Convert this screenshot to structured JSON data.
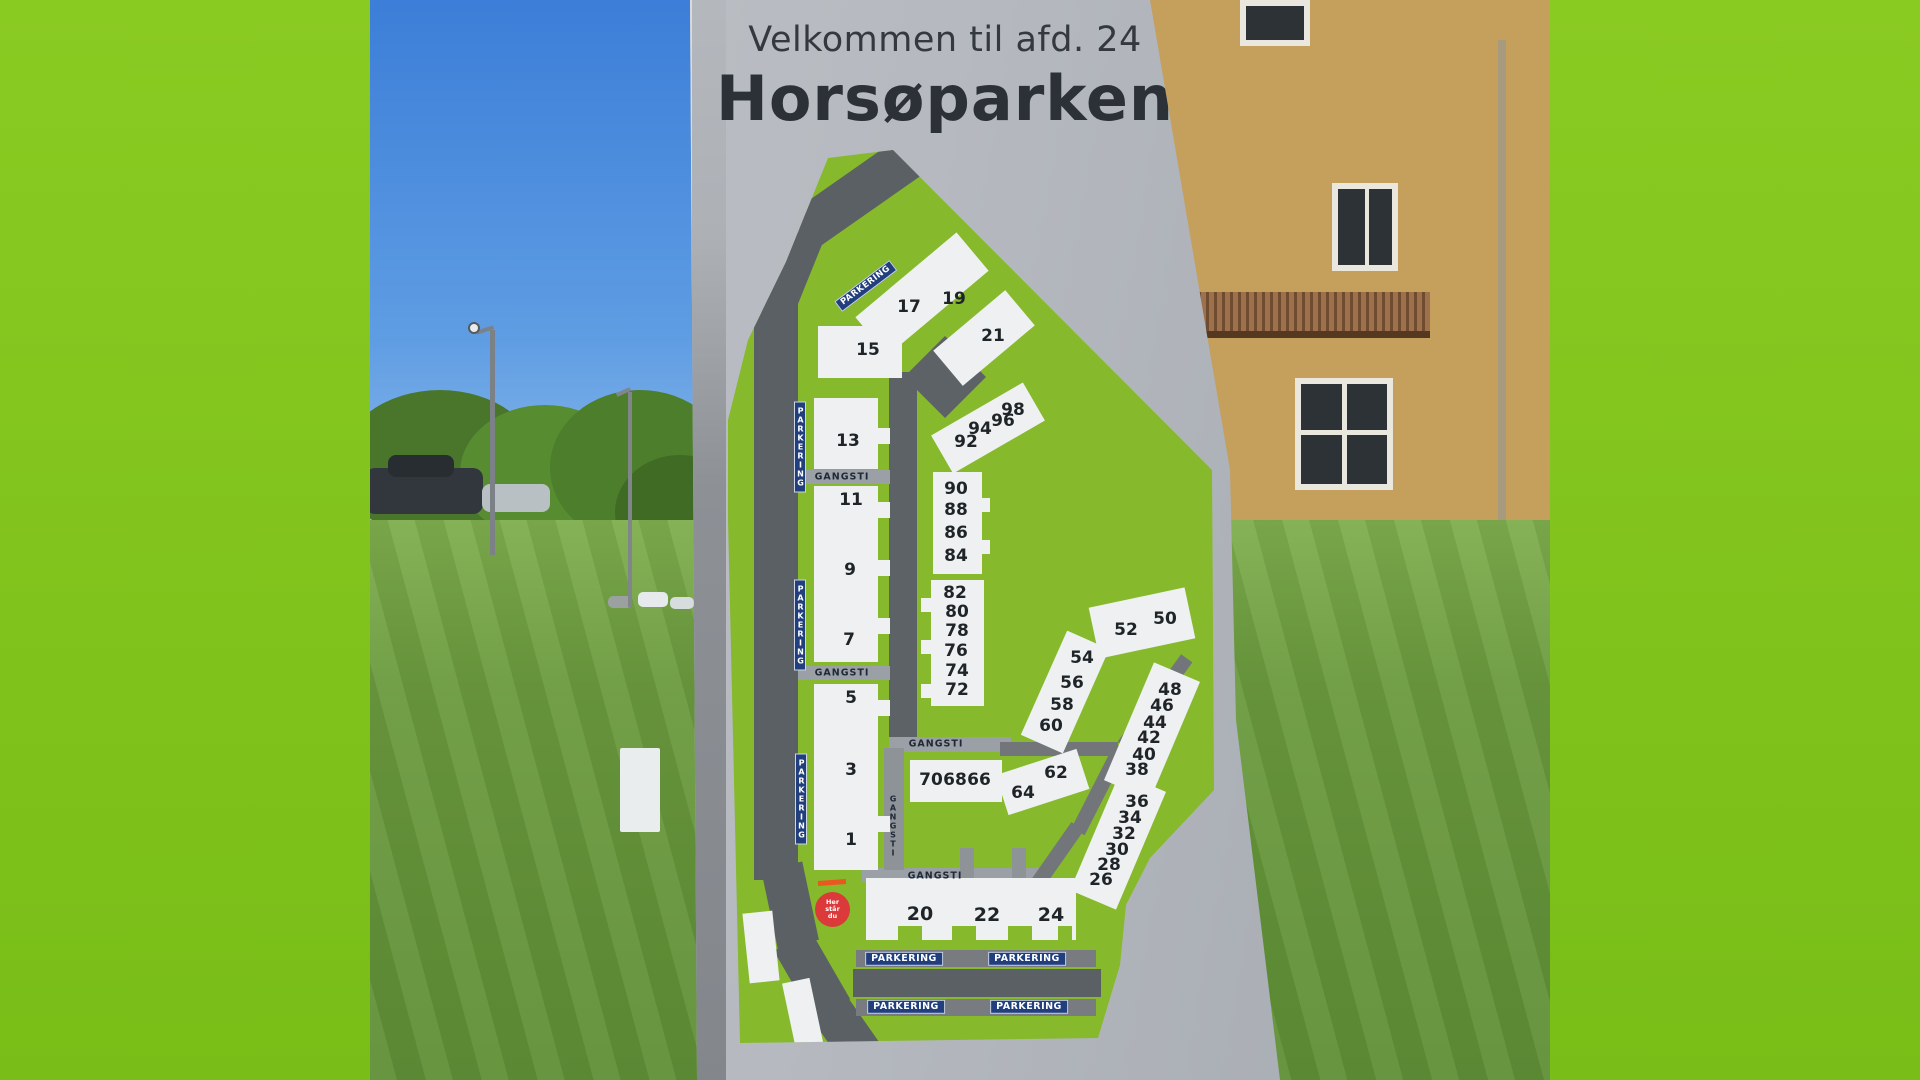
{
  "sign": {
    "title_line1": "Velkommen til afd. 24",
    "title_line2": "Horsøparken"
  },
  "map": {
    "units": [
      "1",
      "3",
      "5",
      "7",
      "9",
      "11",
      "13",
      "15",
      "17",
      "19",
      "21",
      "20",
      "22",
      "24",
      "26",
      "28",
      "30",
      "32",
      "34",
      "36",
      "38",
      "40",
      "42",
      "44",
      "46",
      "48",
      "50",
      "52",
      "54",
      "56",
      "58",
      "60",
      "62",
      "64",
      "66",
      "68",
      "70",
      "72",
      "74",
      "76",
      "78",
      "80",
      "82",
      "84",
      "86",
      "88",
      "90",
      "92",
      "94",
      "96",
      "98"
    ]
  },
  "labels": {
    "parkering": "PARKERING",
    "gangsti": "GANGSTI",
    "marker": [
      "Her",
      "står",
      "du"
    ]
  },
  "colors": {
    "frame_green": "#84c81f",
    "map_green": "#86b92b",
    "sign_gray": "#b6bac0",
    "road_gray": "#5b6064",
    "footpath_gray": "#9aa0a5",
    "building_white": "#eef0f1",
    "label_navy": "#223f7d",
    "marker_red": "#dc3a3a"
  }
}
